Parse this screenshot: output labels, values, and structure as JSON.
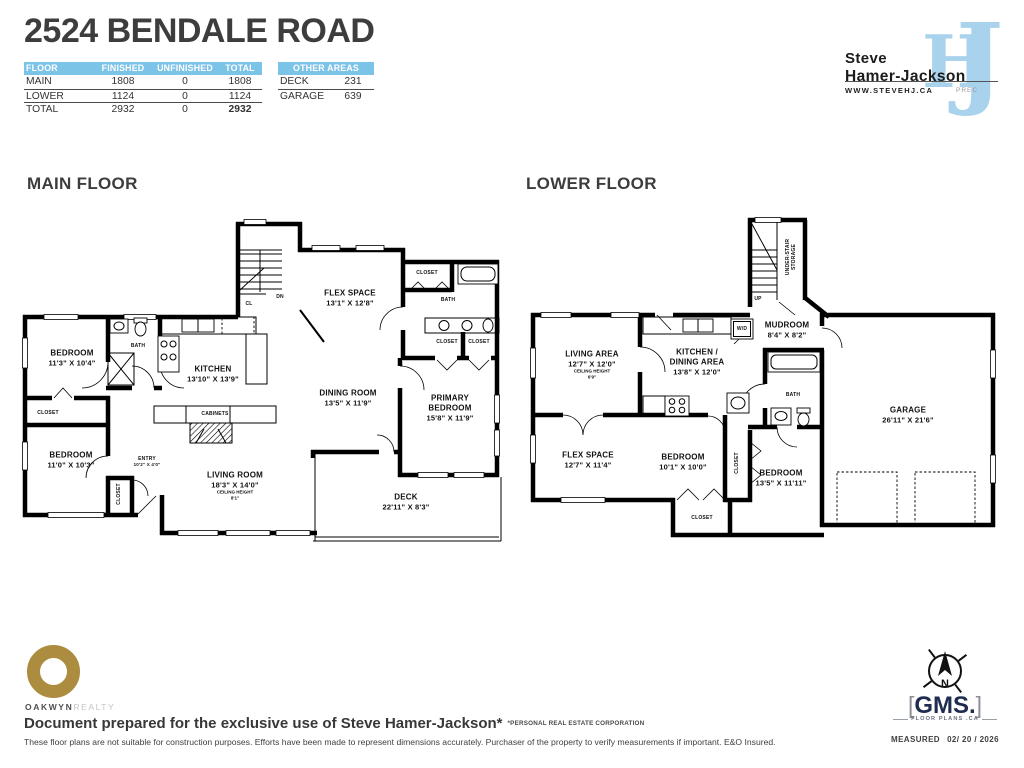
{
  "header": {
    "title": "2524 BENDALE ROAD",
    "floor_table": {
      "columns": [
        "FLOOR",
        "FINISHED",
        "UNFINISHED",
        "TOTAL"
      ],
      "rows": [
        {
          "floor": "MAIN",
          "finished": "1808",
          "unfinished": "0",
          "total": "1808"
        },
        {
          "floor": "LOWER",
          "finished": "1124",
          "unfinished": "0",
          "total": "1124"
        },
        {
          "floor": "TOTAL",
          "finished": "2932",
          "unfinished": "0",
          "total": "2932"
        }
      ]
    },
    "other_areas": {
      "header": "OTHER AREAS",
      "rows": [
        {
          "name": "DECK",
          "value": "231"
        },
        {
          "name": "GARAGE",
          "value": "639"
        }
      ]
    },
    "agent": {
      "first_name": "Steve",
      "last_name": "Hamer-Jackson",
      "website": "WWW.STEVEHJ.CA",
      "designation": "PREC",
      "monogram_h": "H",
      "monogram_j": "J"
    }
  },
  "main_floor": {
    "heading": "MAIN FLOOR",
    "rooms": {
      "bedroom1": {
        "name": "BEDROOM",
        "dims": "11'3\" X 10'4\""
      },
      "bath": {
        "name": "BATH"
      },
      "kitchen": {
        "name": "KITCHEN",
        "dims": "13'10\" X 13'9\""
      },
      "closet_left": {
        "name": "CLOSET"
      },
      "bedroom2": {
        "name": "BEDROOM",
        "dims": "11'0\" X 10'3\""
      },
      "closet_vertical": {
        "name": "CLOSET"
      },
      "entry": {
        "name": "ENTRY",
        "dims": "10'2\" X 4'0\""
      },
      "cabinets": {
        "name": "CABINETS"
      },
      "living_room": {
        "name": "LIVING ROOM",
        "dims": "18'3\" X 14'0\"",
        "note_label": "CEILING HEIGHT",
        "note_value": "8'1\""
      },
      "dining_room": {
        "name": "DINING ROOM",
        "dims": "13'5\" X 11'9\""
      },
      "flex_space": {
        "name": "FLEX SPACE",
        "dims": "13'1\" X 12'8\""
      },
      "primary_bedroom": {
        "name_line1": "PRIMARY",
        "name_line2": "BEDROOM",
        "dims": "15'8\" X 11'9\""
      },
      "deck": {
        "name": "DECK",
        "dims": "22'11\" X 8'3\""
      },
      "closet_top_right": {
        "name": "CLOSET"
      },
      "bath2": {
        "name": "BATH"
      },
      "closet_a": {
        "name": "CLOSET"
      },
      "closet_b": {
        "name": "CLOSET"
      },
      "stairs_down": {
        "name": "DN"
      },
      "closet_cl": {
        "name": "CL"
      }
    }
  },
  "lower_floor": {
    "heading": "LOWER FLOOR",
    "rooms": {
      "under_stair_storage": {
        "line1": "UNDER-STAIR",
        "line2": "STORAGE"
      },
      "stairs_up": {
        "name": "UP"
      },
      "mudroom": {
        "name": "MUDROOM",
        "dims": "8'4\" X 8'2\""
      },
      "living_area": {
        "name": "LIVING AREA",
        "dims": "12'7\" X 12'0\"",
        "note_label": "CEILING HEIGHT",
        "note_value": "6'9\""
      },
      "kitchen_dining": {
        "name_line1": "KITCHEN /",
        "name_line2": "DINING AREA",
        "dims": "13'8\" X 12'0\""
      },
      "washer_dryer": {
        "name": "W/D"
      },
      "flex_space": {
        "name": "FLEX SPACE",
        "dims": "12'7\" X 11'4\""
      },
      "bedroom1": {
        "name": "BEDROOM",
        "dims": "10'1\" X 10'0\""
      },
      "bedroom2": {
        "name": "BEDROOM",
        "dims": "13'5\" X 11'11\""
      },
      "bath": {
        "name": "BATH"
      },
      "garage": {
        "name": "GARAGE",
        "dims": "26'11\" X 21'6\""
      },
      "closet_mid": {
        "name": "CLOSET"
      },
      "closet_bottom": {
        "name": "CLOSET"
      }
    }
  },
  "footer": {
    "brokerage": {
      "word1": "OAKWYN",
      "word2": "REALTY"
    },
    "prepared_line": "Document prepared for the exclusive use of Steve Hamer-Jackson*",
    "prepared_note": "*PERSONAL REAL ESTATE CORPORATION",
    "disclaimer": "These floor plans are not suitable for construction purposes. Efforts have been made to represent dimensions accurately.  Purchaser of the property to verify measurements if important.  E&O Insured.",
    "compass_label": "N",
    "gms": {
      "bracket_left": "[",
      "name": "GMS.",
      "bracket_right": "]",
      "tagline": "FLOOR PLANS .CA"
    },
    "measured_label": "MEASURED",
    "measured_date": "02/ 20 / 2026"
  },
  "colors": {
    "table_header_blue": "#7cc3e8",
    "monogram_blue": "#a9d2ec",
    "oakwyn_gold": "#ac8c3e",
    "gms_navy": "#1e2c50",
    "wall_black": "#000000",
    "text_dark": "#3d3d3d"
  }
}
